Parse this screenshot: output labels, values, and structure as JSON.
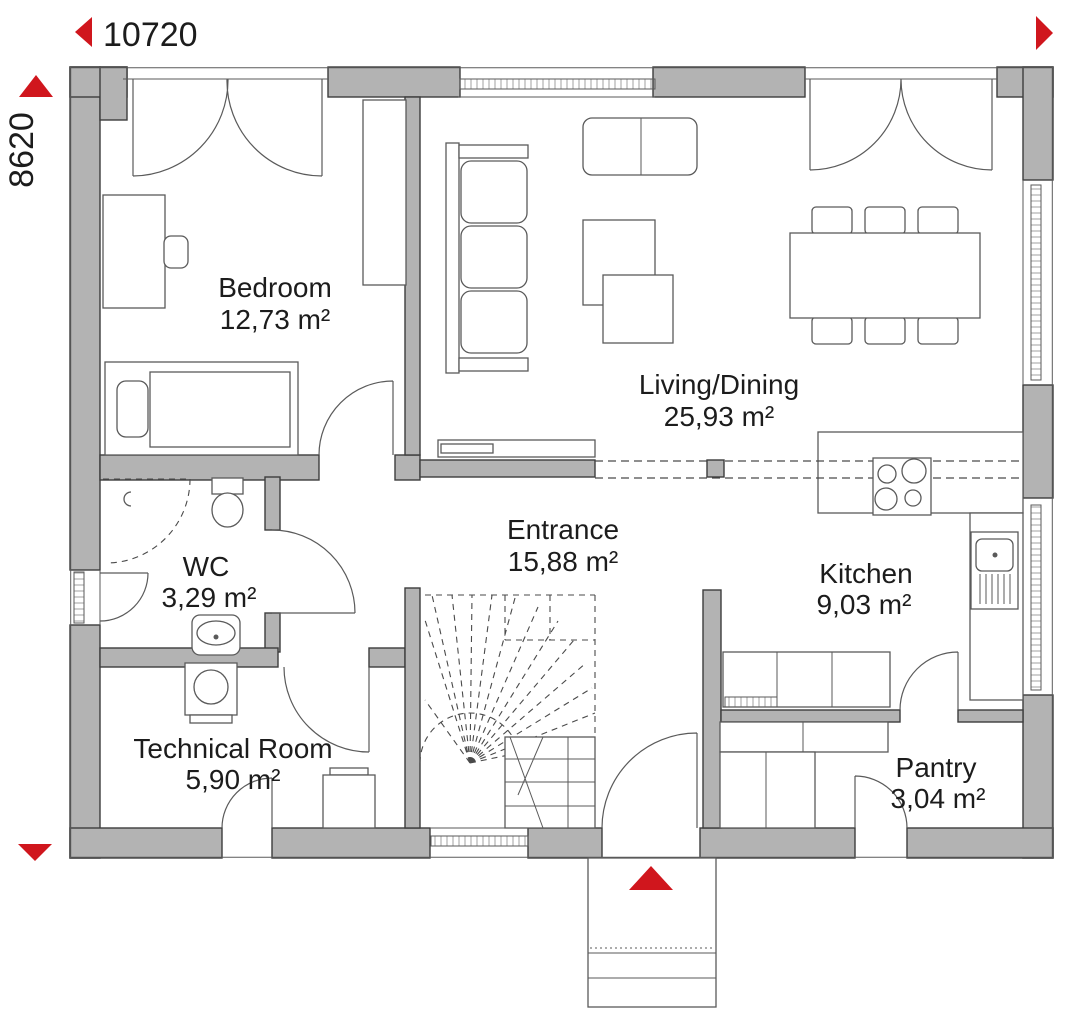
{
  "plan": {
    "type": "house-floor-plan",
    "dimensions": {
      "width_label": "10720",
      "height_label": "8620"
    },
    "rooms": {
      "bedroom": {
        "name": "Bedroom",
        "area": "12,73 m²"
      },
      "living": {
        "name": "Living/Dining",
        "area": "25,93 m²"
      },
      "entrance": {
        "name": "Entrance",
        "area": "15,88 m²"
      },
      "wc": {
        "name": "WC",
        "area": "3,29 m²"
      },
      "kitchen": {
        "name": "Kitchen",
        "area": "9,03 m²"
      },
      "technical": {
        "name": "Technical Room",
        "area": "5,90 m²"
      },
      "pantry": {
        "name": "Pantry",
        "area": "3,04 m²"
      }
    },
    "colors": {
      "wall_fill": "#b3b3b3",
      "accent_red": "#d0161d",
      "line": "#4a4a4a",
      "background": "#ffffff"
    }
  }
}
